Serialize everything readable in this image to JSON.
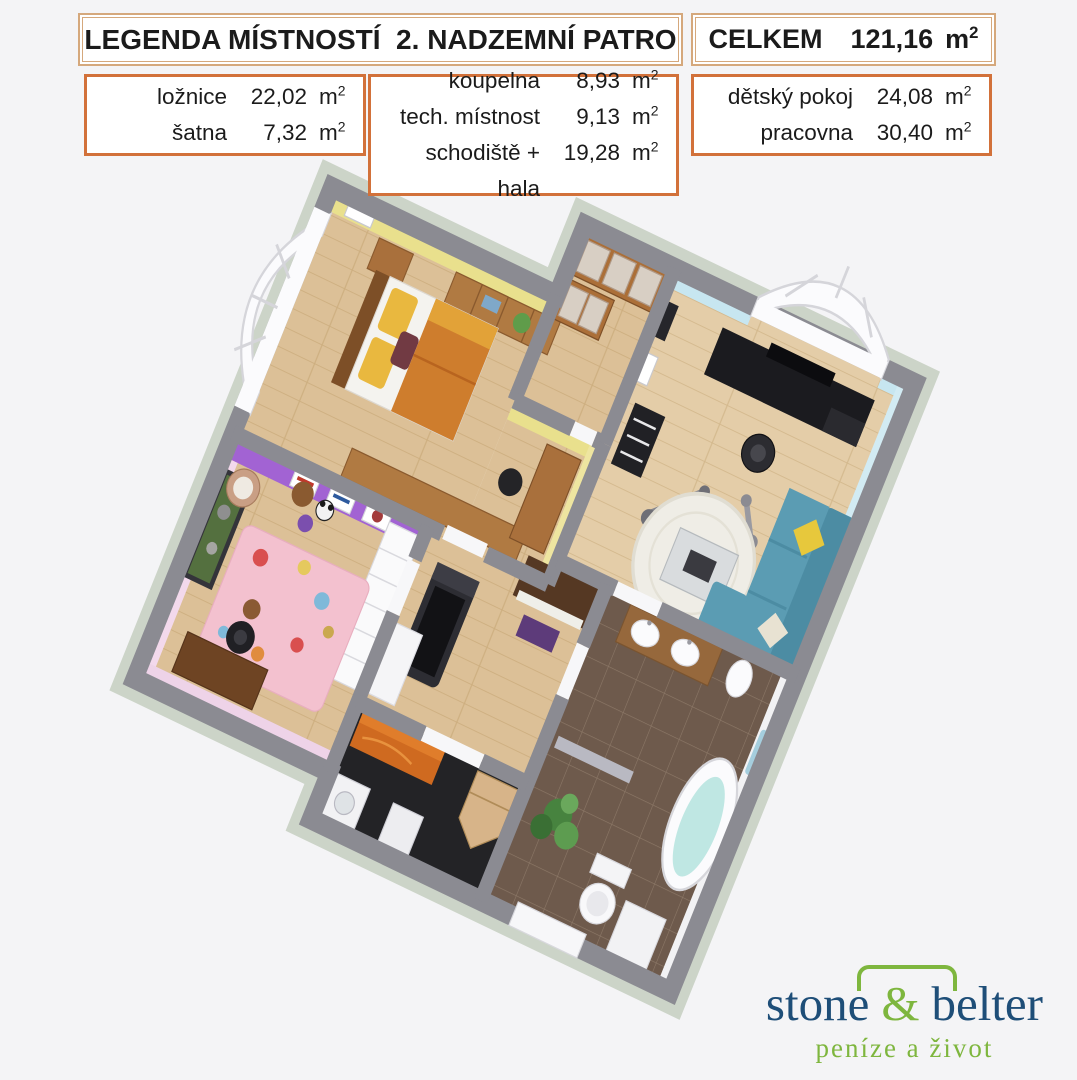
{
  "header": {
    "title": "LEGENDA MÍSTNOSTÍ  2. NADZEMNÍ PATRO",
    "total_label": "CELKEM",
    "total_value": "121,16",
    "unit_base": "m",
    "unit_exp": "2"
  },
  "legend": {
    "unit_base": "m",
    "unit_exp": "2",
    "groups": [
      {
        "rows": [
          {
            "name": "ložnice",
            "area": "22,02"
          },
          {
            "name": "šatna",
            "area": "7,32"
          }
        ]
      },
      {
        "rows": [
          {
            "name": "koupelna",
            "area": "8,93"
          },
          {
            "name": "tech. místnost",
            "area": "9,13"
          },
          {
            "name": "schodiště + hala",
            "area": "19,28"
          }
        ]
      },
      {
        "rows": [
          {
            "name": "dětský pokoj",
            "area": "24,08"
          },
          {
            "name": "pracovna",
            "area": "30,40"
          }
        ]
      }
    ]
  },
  "logo": {
    "word1": "stone",
    "amp": "&",
    "word2": "belter",
    "tagline": "peníze a život"
  },
  "colors": {
    "header_border": "#d5a87c",
    "legend_border": "#d2713a",
    "logo_blue": "#1e4e78",
    "logo_green": "#7eb63e",
    "wall_top_gray": "#8b8b92",
    "plinth": "#ccd4c8",
    "floor_wood": "#dcc097",
    "floor_tile_brown": "#6e5a4c",
    "floor_dark": "#232326",
    "bedroom_wall_yellow": "#e9e08d",
    "kids_wall_purple": "#a263d3",
    "kids_wall_pink": "#f3d9ec",
    "office_wall_blue": "#c7e6f0",
    "sofa_blue": "#5b9cb3",
    "bed_blanket_orange": "#ce7d2d",
    "rug_pink": "#f3c1cf",
    "bath_water": "#bfe7e3"
  },
  "floorplan": {
    "type": "3d-isometric-floorplan-render",
    "rooms": [
      {
        "name": "ložnice",
        "wall": "yellow",
        "furniture": [
          "double bed",
          "nightstand",
          "dresser with plant",
          "wood desk",
          "black stool",
          "low bench"
        ]
      },
      {
        "name": "šatna",
        "wall": "white",
        "furniture": [
          "wooden shelving with drawers"
        ]
      },
      {
        "name": "pracovna",
        "wall": "light blue",
        "furniture": [
          "black desk with monitor",
          "office chair",
          "black shelf",
          "blue corner sofa",
          "yellow pillow",
          "round white rug",
          "glass coffee table",
          "exercise machines",
          "arched window"
        ]
      },
      {
        "name": "dětský pokoj",
        "wall": "purple and pink",
        "furniture": [
          "terrarium",
          "white dresser",
          "pink ice-cream rug",
          "desk with office chair",
          "basket chair",
          "teddy bear",
          "panda toy",
          "posters"
        ]
      },
      {
        "name": "schodiště + hala",
        "wall": "white",
        "furniture": [
          "treadmill",
          "piano with purple bench",
          "white cabinet"
        ]
      },
      {
        "name": "tech. místnost",
        "wall": "white",
        "furniture": [
          "orange chest",
          "washing machine",
          "corner wood cabinet",
          "white bin"
        ]
      },
      {
        "name": "koupelna",
        "wall": "white",
        "furniture": [
          "double sink counter",
          "freestanding bathtub",
          "toilet",
          "bidet",
          "palm plant",
          "radiator",
          "blue towel"
        ]
      }
    ]
  }
}
